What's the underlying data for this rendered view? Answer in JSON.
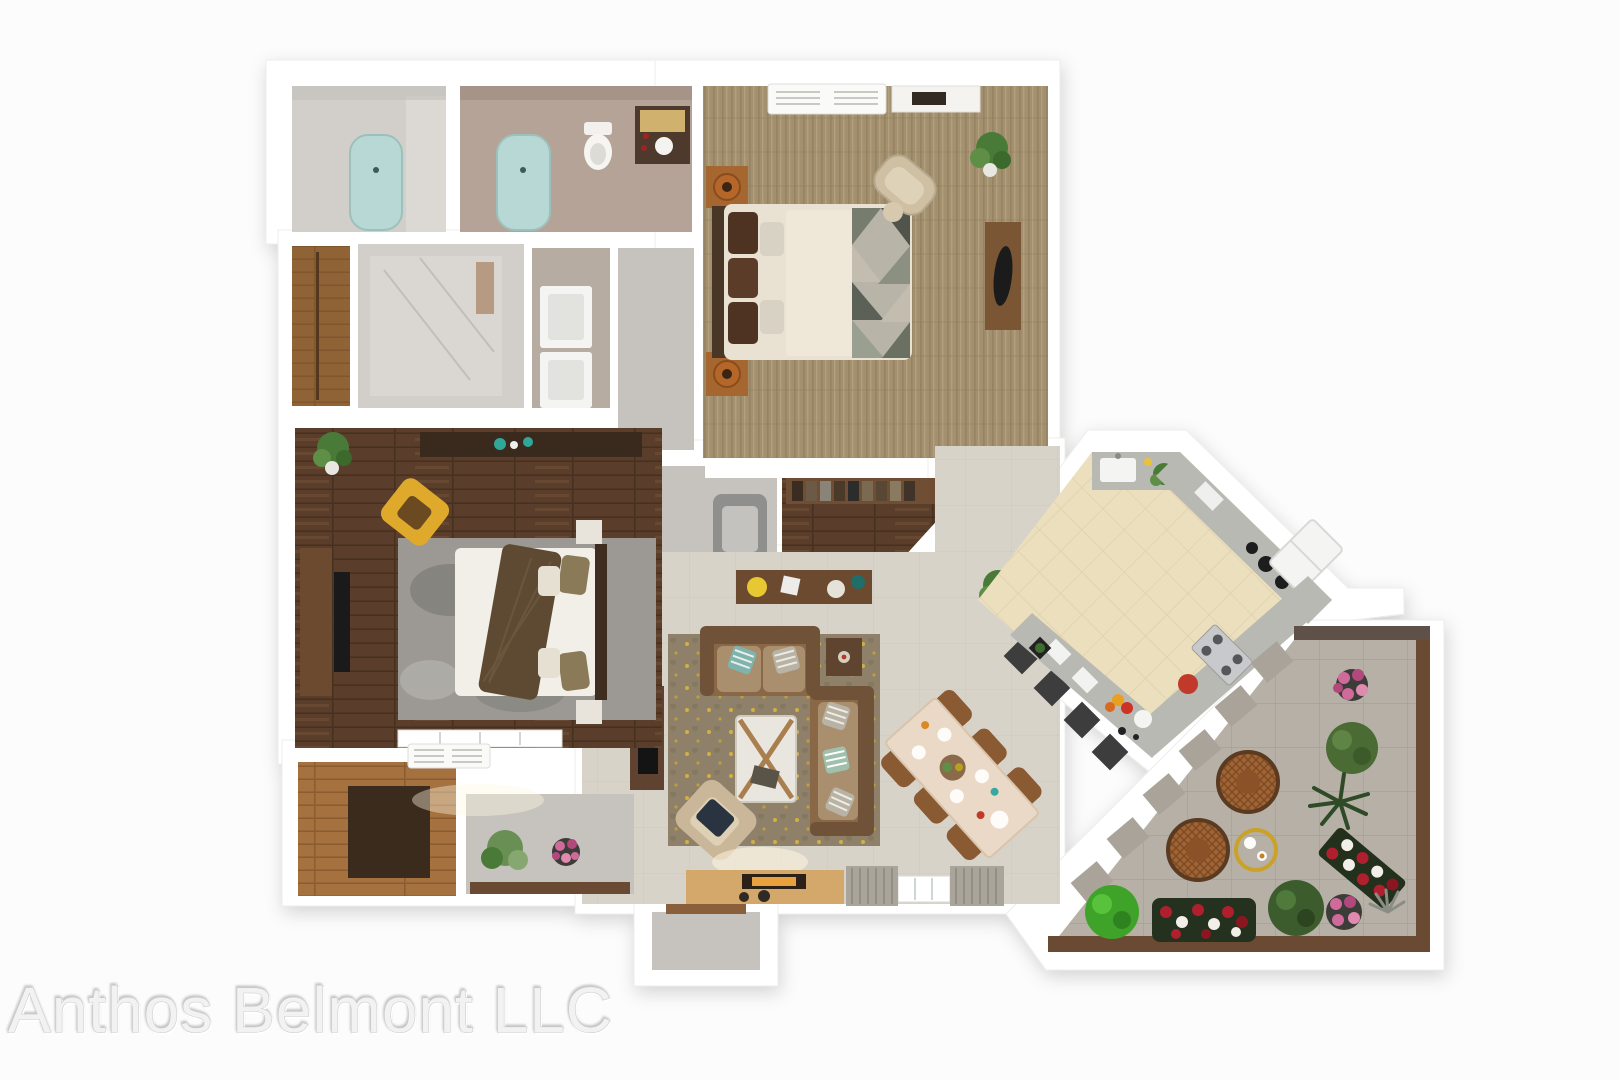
{
  "watermark": {
    "text": "Anthos Belmont LLC"
  },
  "palette": {
    "background": "#fcfcfc",
    "wall": "#ffffff",
    "tile_living": "#d8d3c9",
    "carpet_master": "#a3906f",
    "wood_dark": "#5a3e2b",
    "wood_mid": "#8a6040",
    "wood_light": "#a4713f",
    "marble": "#d2cfca",
    "taupe": "#b4a396",
    "concrete": "#c6c3be",
    "tub": "#b7d8d4",
    "counter": "#b9b9b4",
    "kitchen_floor": "#ebdfbd",
    "patio_stone": "#b6b0a7",
    "patio_wood": "#6b4a33",
    "rug_living": "#8e8069",
    "rug_gray": "#9c9994",
    "sofa": "#8a6847",
    "chair_yellow": "#dfa92b",
    "dining_wood": "#8a5a33",
    "table_cream": "#ead9c6",
    "leaf": "#4a7a38",
    "leaf_bright": "#3fa32a",
    "rose_red": "#b01f2e",
    "flower_pink": "#d06a9a",
    "accent_teal": "#2fa89a",
    "lamp_copper": "#b5672a",
    "stool_dark": "#3d3d3d",
    "fire_glow": "#e8a13c",
    "curtain": "#aaa59b",
    "watermark_text_color": "#f2f2f2"
  }
}
